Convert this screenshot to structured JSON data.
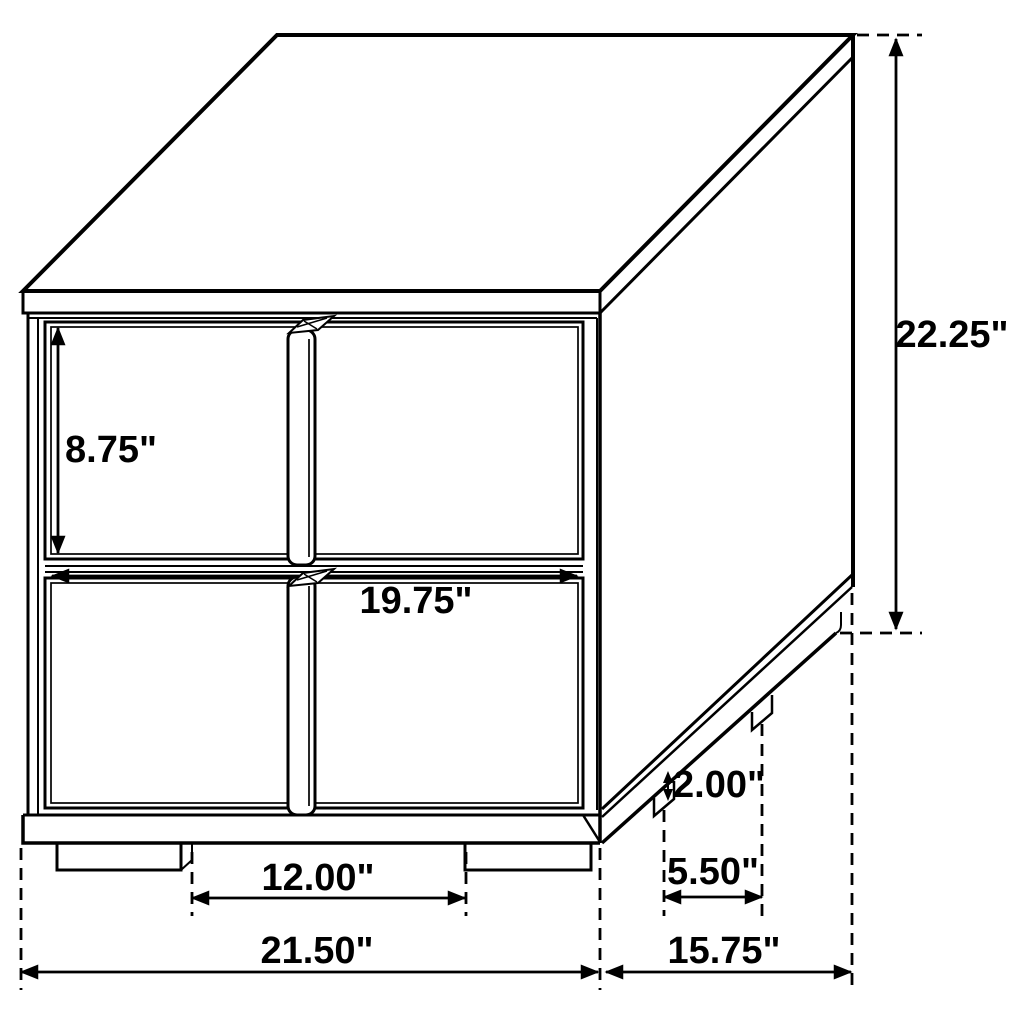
{
  "drawing": {
    "dimensions": {
      "drawer_height": "8.75\"",
      "overall_height": "22.25\"",
      "drawer_width": "19.75\"",
      "foot_height": "2.00\"",
      "front_feet_spacing": "12.00\"",
      "side_feet_spacing": "5.50\"",
      "overall_width": "21.50\"",
      "overall_depth": "15.75\""
    },
    "colors": {
      "line": "#000000",
      "background": "#ffffff"
    }
  }
}
